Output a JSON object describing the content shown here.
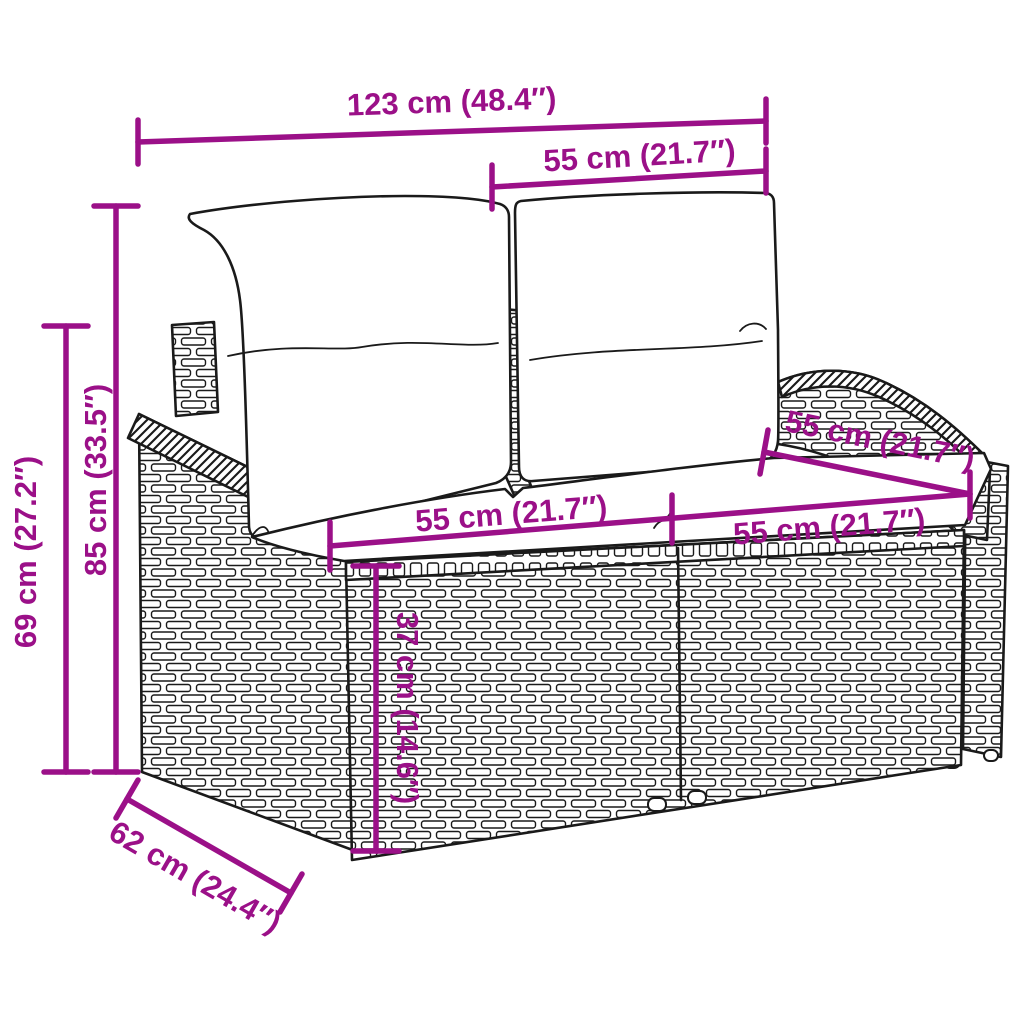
{
  "colors": {
    "accent": "#9b1088",
    "line_art": "#1a1a1a",
    "background": "#ffffff"
  },
  "illustration": {
    "name": "poly-rattan-2-seater-garden-sofa-line-art",
    "parts": [
      "back-cushion-left",
      "back-cushion-right",
      "seat-cushion",
      "left-armrest",
      "right-armrest",
      "front-panel",
      "right-side-panel"
    ]
  },
  "dimensions": {
    "overall_width": "123 cm (48.4″)",
    "backrest_width": "55 cm (21.7″)",
    "overall_height": "85 cm (33.5″)",
    "armrest_height": "69 cm (27.2″)",
    "seat_depth": "55 cm (21.7″)",
    "seat_width_left": "55 cm (21.7″)",
    "seat_width_right": "55 cm (21.7″)",
    "seat_height": "37 cm (14.6″)",
    "overall_depth": "62 cm (24.4″)"
  }
}
